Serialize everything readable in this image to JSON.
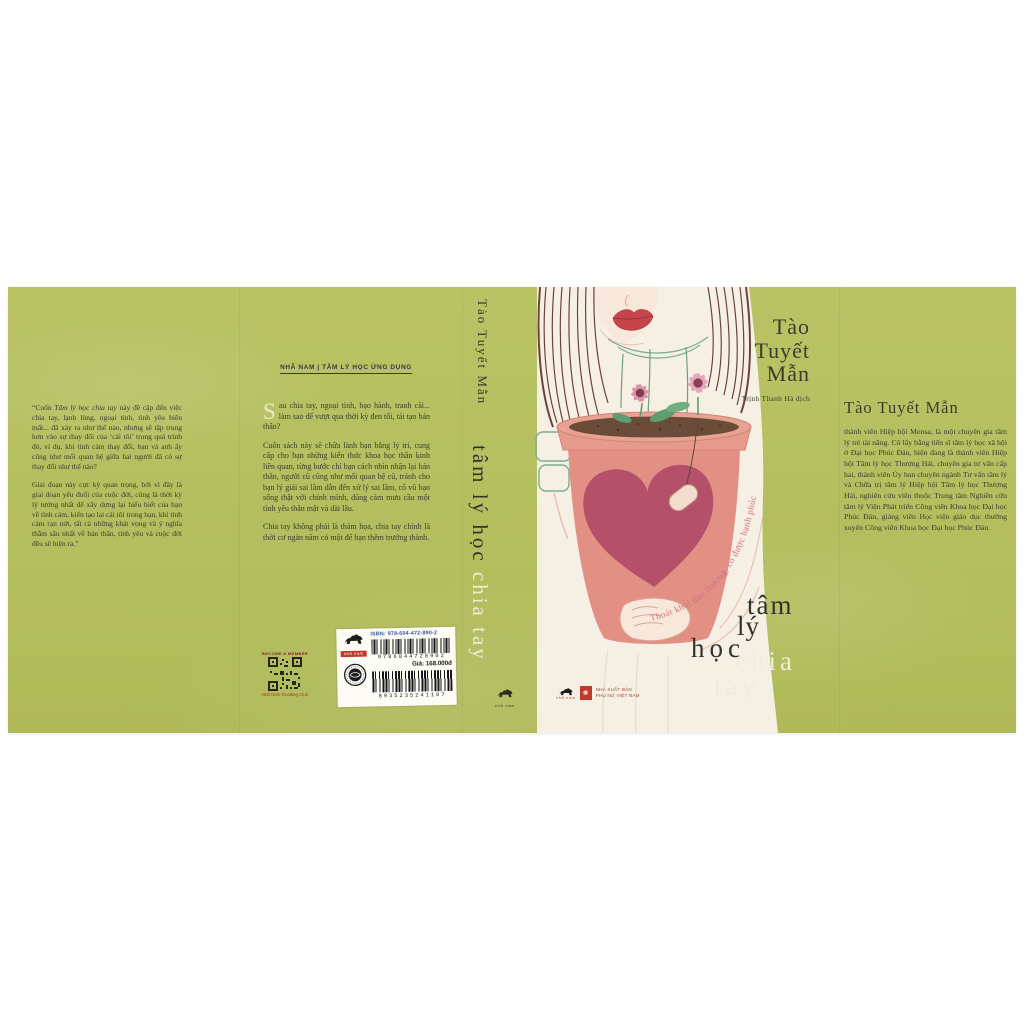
{
  "book": {
    "back_cover": {
      "quote_open": "“Cuốn ",
      "quote_book_title": "Tâm lý học chia tay",
      "quote_rest_p1": " này đề cập đến việc chia tay, lạnh lùng, ngoại tình, tình yêu biến mất... đã xảy ra như thế nào, nhưng sẽ tập trung hơn vào sự thay đổi của ‘cái tôi’ trong quá trình đó, ví dụ, khi tình cảm thay đổi, bạn và anh ấy cũng như mối quan hệ giữa hai người đã có sự thay đổi như thế nào?",
      "quote_p2": "Giai đoạn này cực kỳ quan trọng, bởi vì đây là giai đoạn yếu đuối của cuộc đời, cũng là thời kỳ lý tưởng nhất để xây dựng lại hiểu biết của bạn về tình cảm, kiến tạo lại cái tôi trong bạn, khi tình cảm rạn nứt, tất cả những khát vọng và ý nghĩa thẳm sâu nhất về bản thân, tình yêu và cuộc đời đều sẽ hiện ra.”"
    },
    "inner_flap": {
      "header": "NHÃ NAM | TÂM LÝ HỌC ỨNG DỤNG",
      "dropcap": "S",
      "p1_rest": "au chia tay, ngoại tình, bạo hành, tranh cãi... làm sao để vượt qua thời kỳ đen tối, tái tạo bản thân?",
      "p2": "Cuốn sách này sẽ chữa lành bạn bằng lý trí, cung cấp cho bạn những kiến thức khoa học thần kinh liên quan, từng bước chỉ bạn cách nhìn nhận lại bản thân, người cũ cũng như mối quan hệ cũ, tránh cho bạn lý giải sai lầm dẫn đến xử lý sai lầm, cổ vũ bạn sống thật với chính mình, dũng cảm mưu cầu một tình yêu thân mật và dài lâu.",
      "p3": "Chia tay không phải là thảm họa, chia tay chính là thời cơ ngàn năm có một để bạn thêm trưởng thành."
    },
    "spine": {
      "author": "Tào Tuyết Mẫn",
      "title_main": "tâm lý học ",
      "title_accent": "chia tay",
      "logo_text": "nhã nam"
    },
    "front": {
      "author_line1": "Tào",
      "author_line2": "Tuyết",
      "author_line3": "Mẫn",
      "translator": "Trịnh Thanh Hà dịch",
      "tagline": "Thoát khỏi đau thương, có được hạnh phúc",
      "title_w1": "tâm",
      "title_w2": "lý",
      "title_w3": "học",
      "title_w4": "chia",
      "title_w5": "tay",
      "publisher_logo_text": "nhã nam",
      "publisher_line1": "NHÀ XUẤT BẢN",
      "publisher_line2": "PHỤ NỮ VIỆT NAM"
    },
    "back_flap": {
      "heading": "Tào Tuyết Mẫn",
      "bio": "thành viên Hiệp hội Mensa, là một chuyên gia tâm lý trẻ tài năng. Cô lấy bằng tiến sĩ tâm lý học xã hội ở Đại học Phúc Đán, hiện đang là thành viên Hiệp hội Tâm lý học Thượng Hải, chuyên gia tư vấn cấp hai, thành viên Ủy ban chuyên ngành Tư vấn tâm lý và Chữa trị tâm lý Hiệp hội Tâm lý học Thượng Hải, nghiên cứu viên thuộc Trung tâm Nghiên cứu tâm lý Viện Phát triển Công viên Khoa học Đại học Phúc Đán, giảng viên Học viện giáo dục thường xuyên Công viên Khoa học Đại học Phúc Đán."
    },
    "barcode_label": {
      "logo_text": "nhã nam",
      "isbn": "ISBN: 978-604-472-890-2",
      "ean": "9786044728902",
      "price": "Giá: 168.000đ",
      "code2": "8935235241107"
    },
    "qr": {
      "top": "BECOME A MEMBER",
      "bottom": "Nhã Nam Reading Club"
    }
  },
  "colors": {
    "cover_green": "#b5c05c",
    "ink": "#3b3c2f",
    "cream_accent": "#efecd6",
    "tagline_pink": "#d4717f",
    "pot_salmon": "#e59a8c",
    "heart_rose": "#b4506a",
    "publisher_red": "#c03a2c",
    "isbn_blue": "#3a55a0"
  }
}
